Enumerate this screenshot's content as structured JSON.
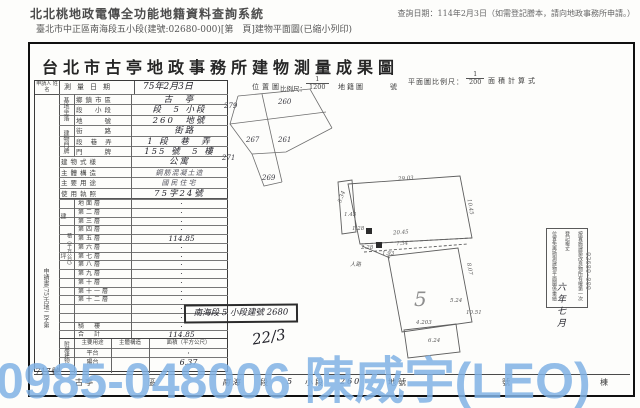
{
  "header": {
    "system_title": "北北桃地政電傳全功能地籍資料查詢系統",
    "query_date": "查詢日期：114年2月3日（如需登記謄本，請向地政事務所申請。）",
    "doc_line": "臺北市中正區南海段五小段(建號:02680-000)[第　頁]建物平面圖(已縮小列印)"
  },
  "doc": {
    "title": "台北市古亭地政事務所建物測量成果圖",
    "strip": {
      "applicant": "申請人 姓名",
      "survey_label": "測量日期",
      "survey_value": "75年2月3日",
      "loc_label": "位置圖",
      "scale_label": "比例尺：",
      "loc_num": "1",
      "loc_den": "1200",
      "cadastre": "地籍圖",
      "no": "號",
      "plan_scale_label": "平面圖比例尺：",
      "plan_num": "1",
      "plan_den": "200",
      "area_calc": "面積計算式"
    },
    "form": {
      "groups": {
        "site": "基地坐落",
        "addr": "建物門牌",
        "area_a": "建　坪",
        "area_b": "積（平方公尺）",
        "annex": "附屬建物"
      },
      "rows": [
        {
          "label": "鄉鎮市區",
          "value": "古　亭"
        },
        {
          "label": "段　小段",
          "value": "段　5 小段"
        },
        {
          "label": "地　　號",
          "value": "260　地號"
        },
        {
          "label": "街　　路",
          "value": "　街路"
        },
        {
          "label": "段 巷 弄",
          "value": "1 段　巷　弄"
        },
        {
          "label": "門　　牌",
          "value": "155 號　5 樓"
        },
        {
          "label": "建物式樣",
          "value": "公寓"
        },
        {
          "label": "主體構造",
          "value": "鋼筋混凝土造"
        },
        {
          "label": "主要用途",
          "value": "國民住宅"
        },
        {
          "label": "使用執照",
          "value": "75字24號"
        }
      ],
      "floors": [
        {
          "label": "地面層",
          "value": "·"
        },
        {
          "label": "第二層",
          "value": "·"
        },
        {
          "label": "第三層",
          "value": "·"
        },
        {
          "label": "第四層",
          "value": "·"
        },
        {
          "label": "第五層",
          "value": "114.85"
        },
        {
          "label": "第六層",
          "value": "·"
        },
        {
          "label": "第七層",
          "value": "·"
        },
        {
          "label": "第八層",
          "value": "·"
        },
        {
          "label": "第九層",
          "value": "·"
        },
        {
          "label": "第十層",
          "value": "·"
        },
        {
          "label": "第十一層",
          "value": "·"
        },
        {
          "label": "第十二層",
          "value": "·"
        },
        {
          "label": "",
          "value": "·"
        },
        {
          "label": "",
          "value": "·"
        },
        {
          "label": "騎　樓",
          "value": "·"
        },
        {
          "label": "合　計",
          "value": "114.85"
        }
      ],
      "annex_headers": [
        "主要用途",
        "主體構造",
        "面積（平方公尺）"
      ],
      "annex_rows": [
        {
          "use": "平台",
          "structure": "",
          "area": "·"
        },
        {
          "use": "陽台",
          "structure": "",
          "area": "6.37"
        }
      ],
      "margin_note": "申請書(75)古地二字第",
      "case_no": "717號"
    },
    "location_plots": [
      "279",
      "260",
      "267",
      "261",
      "271",
      "269"
    ],
    "plan": {
      "building": "5",
      "dims": [
        "29.03",
        "10.45",
        "5.34",
        "1.43",
        "1.28",
        "20.45",
        "7.34",
        "1.93",
        "2.28",
        "人路",
        "8.07",
        "5.24",
        "10.51",
        "4.203",
        "6.24"
      ]
    },
    "stamp": {
      "l1": "按實施建築改良物所有權第一次登記複丈",
      "l2": "位置免再勘測建物平面圖係重繪比照建物",
      "l3": "併檢使用執照",
      "hand": "六年七月"
    },
    "notes": {
      "section_box": "南海段 5 小段建號 2680",
      "fraction": "22/3"
    },
    "edge": "02680-000",
    "footer": [
      "古亭",
      "區",
      "南海",
      "段",
      "5",
      "小段",
      "260",
      "地號",
      "號",
      "棟"
    ]
  },
  "watermark": {
    "text": "0985-048006 陳威宇(LEO)",
    "color": "#80b2e4"
  }
}
